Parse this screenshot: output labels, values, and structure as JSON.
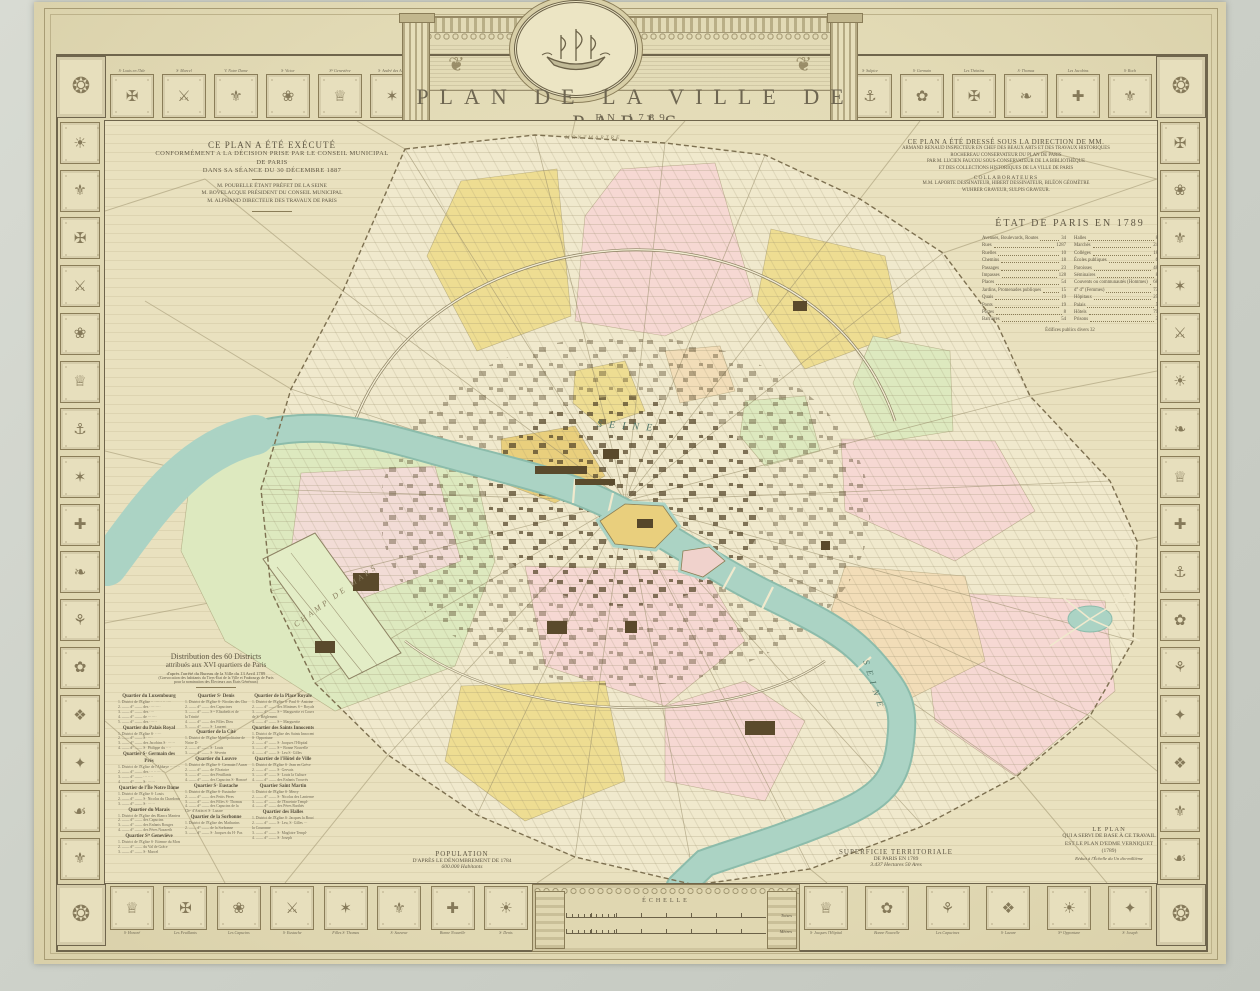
{
  "colors": {
    "paper": "#e3dbb6",
    "map_paper": "#f0e9cd",
    "river": "#abd3c4",
    "yellow": "#eedd92",
    "pink": "#f6d8d3",
    "green": "#dde9bf",
    "peach": "#f2ddb8",
    "gold": "#e9cf7d",
    "ink": "#5f5744",
    "sepia": "#8a7d58"
  },
  "title": {
    "line1": "PLAN DE LA VILLE DE PARIS",
    "line2": "EN 1789"
  },
  "left_note": {
    "l1": "CE PLAN A ÉTÉ EXÉCUTÉ",
    "l2": "CONFORMÉMENT A LA DÉCISION PRISE PAR LE CONSEIL MUNICIPAL",
    "l3": "DE PARIS",
    "l4": "DANS SA SÉANCE DU 30 DÉCEMBRE 1887",
    "l5": "M. POUBELLE ÉTANT PRÉFET DE LA SEINE",
    "l6": "M. BOVELACQUE PRÉSIDENT DU CONSEIL MUNICIPAL",
    "l7": "M. ALPHAND DIRECTEUR DES TRAVAUX DE PARIS"
  },
  "right_note": {
    "l1": "CE PLAN A ÉTÉ DRESSÉ SOUS LA DIRECTION DE MM.",
    "l2": "ARMAND RENAUD INSPECTEUR EN CHEF DES BEAUX ARTS ET DES TRAVAUX HISTORIQUES",
    "l3": "ROCHEREAU CONSERVATEUR DU PLAN DE PARIS",
    "l4": "PAR M. LUCIEN FAUCOU SOUS-CONSERVATEUR DE LA BIBLIOTHÈQUE",
    "l5": "ET DES COLLECTIONS HISTORIQUES DE LA VILLE DE PARIS",
    "collab_title": "COLLABORATEURS",
    "c1": "M.M. LAPORTE DESSINATEUR, HIBERT DESSINATEUR, BILÉON GÉOMÈTRE",
    "c2": "WUHRER GRAVEUR, SULPIS GRAVEUR."
  },
  "etat": {
    "title": "ÉTAT DE PARIS EN 1789",
    "left": [
      {
        "label": "Avenues, Boulevards, Routes",
        "value": "34"
      },
      {
        "label": "Rues",
        "value": "1287"
      },
      {
        "label": "Ruelles",
        "value": "10"
      },
      {
        "label": "Chemins",
        "value": "18"
      },
      {
        "label": "Passages",
        "value": "23"
      },
      {
        "label": "Impasses",
        "value": "128"
      },
      {
        "label": "Places",
        "value": "54"
      },
      {
        "label": "Jardins, Promenades publiques",
        "value": "15"
      },
      {
        "label": "Quais",
        "value": "19"
      },
      {
        "label": "Ponts",
        "value": "19"
      },
      {
        "label": "Portes",
        "value": "8"
      },
      {
        "label": "Barrières",
        "value": "54"
      }
    ],
    "right": [
      {
        "label": "Halles",
        "value": "8"
      },
      {
        "label": "Marchés",
        "value": "24"
      },
      {
        "label": "Collèges",
        "value": "18"
      },
      {
        "label": "Écoles publiques",
        "value": "6"
      },
      {
        "label": "Paroisses",
        "value": "48"
      },
      {
        "label": "Séminaires",
        "value": "8"
      },
      {
        "label": "Couvents ou communautés (Hommes)",
        "value": "68"
      },
      {
        "label": "d°          d°          (Femmes)",
        "value": "73"
      },
      {
        "label": "Hôpitaux",
        "value": "25"
      },
      {
        "label": "Palais",
        "value": "5"
      },
      {
        "label": "Hôtels",
        "value": "79"
      },
      {
        "label": "Prisons",
        "value": "3"
      }
    ],
    "footer": "Édifices publics divers    32"
  },
  "distribution": {
    "t1": "Distribution des 60 Districts",
    "t2": "attribués aux XVI quartiers de Paris",
    "t3": "d'après l'arrêté du Bureau de la Ville du 13 Avril 1789",
    "t4": "(Convocation des habitants du Tiers-État de la Ville et Faubourgs de Paris",
    "t5": "pour la nomination des Électeurs aux États Généraux)",
    "col1": [
      {
        "c": "qh",
        "s": "Quartier du Luxembourg"
      },
      {
        "c": "qe",
        "s": "1. District de l'Église ·· ······ ·· ····"
      },
      {
        "c": "qe",
        "s": "2. ――  d°  ―― des ·········"
      },
      {
        "c": "qe",
        "s": "3. ――  d°  ―― des ····"
      },
      {
        "c": "qe",
        "s": "4. ――  d°  ―― de ·······"
      },
      {
        "c": "qe",
        "s": "5. ――  d°  ―― des ······"
      },
      {
        "c": "qh",
        "s": "Quartier du Palais Royal"
      },
      {
        "c": "qe",
        "s": "1. District de l'Église S· ·····"
      },
      {
        "c": "qe",
        "s": "2. ――  d°  ―― S· ····"
      },
      {
        "c": "qe",
        "s": "3. ――  d°  ―― des Jacobins S· ······"
      },
      {
        "c": "qe",
        "s": "4. ――  d°  ―― S· Philippe du ····"
      },
      {
        "c": "qh",
        "s": "Quartier S· Germain des Prés"
      },
      {
        "c": "qe",
        "s": "1. District de l'Église de l'Abbaye ········"
      },
      {
        "c": "qe",
        "s": "2. ――  d°  ―― des ··· ·········"
      },
      {
        "c": "qe",
        "s": "3. ――  d°  ―― ··· ····"
      },
      {
        "c": "qe",
        "s": "4. ――  d°  ―― S· ······"
      },
      {
        "c": "qh",
        "s": "Quartier de l'Île Notre Dame"
      },
      {
        "c": "qe",
        "s": "1. District de l'Église S· Louis"
      },
      {
        "c": "qe",
        "s": "2. ――  d°  ―― S· Nicolas du Chardonnet"
      },
      {
        "c": "qe",
        "s": "3. ――  d°  ―― S· ······"
      },
      {
        "c": "qh",
        "s": "Quartier du Marais"
      },
      {
        "c": "qe",
        "s": "1. District de l'Église des Blancs Manteaux"
      },
      {
        "c": "qe",
        "s": "2. ――  d°  ―― des Capucins"
      },
      {
        "c": "qe",
        "s": "3. ――  d°  ―― des Enfants Rouges"
      },
      {
        "c": "qe",
        "s": "4. ――  d°  ―― des Pères Nazareth"
      },
      {
        "c": "qh",
        "s": "Quartier Sᵗᵉ Geneviève"
      },
      {
        "c": "qe",
        "s": "1. District de l'Église S· Étienne du Mont"
      },
      {
        "c": "qe",
        "s": "2. ――  d°  ―― du Val de Grâce"
      },
      {
        "c": "qe",
        "s": "3. ――  d°  ―― S· Marcel"
      }
    ],
    "col2": [
      {
        "c": "qh",
        "s": "Quartier S· Denis"
      },
      {
        "c": "qe",
        "s": "1. District de l'Église S· Nicolas des Champs"
      },
      {
        "c": "qe",
        "s": "2. ――  d°  ―― des Capucines"
      },
      {
        "c": "qe",
        "s": "3. ――  d°  ―― S·ᵗᵉ Élisabeth et de"
      },
      {
        "c": "qe",
        "s": "      la Trinité"
      },
      {
        "c": "qe",
        "s": "4. ――  d°  ―― des Filles Dieu"
      },
      {
        "c": "qe",
        "s": "5. ――  d°  ―― S· Laurent"
      },
      {
        "c": "qh",
        "s": "Quartier de la Cité"
      },
      {
        "c": "qe",
        "s": "1. District de l'Église Métropolitaine de"
      },
      {
        "c": "qe",
        "s": "      Notre D·"
      },
      {
        "c": "qe",
        "s": "2. ――  d°  ―― S· Louis"
      },
      {
        "c": "qe",
        "s": "3. ――  d°  ―― S· Séverin"
      },
      {
        "c": "qh",
        "s": "Quartier du Louvre"
      },
      {
        "c": "qe",
        "s": "1. District de l'Église S· Germain l'Auxerrois"
      },
      {
        "c": "qe",
        "s": "2. ――  d°  ―― de l'Oratoire"
      },
      {
        "c": "qe",
        "s": "3. ――  d°  ―― des Feuillants"
      },
      {
        "c": "qe",
        "s": "4. ――  d°  ―― des Capucins S· Honoré"
      },
      {
        "c": "qh",
        "s": "Quartier S· Eustache"
      },
      {
        "c": "qe",
        "s": "1. District de l'Église S· Eustache"
      },
      {
        "c": "qe",
        "s": "2. ――  d°  ―― des Petits Pères"
      },
      {
        "c": "qe",
        "s": "3. ――  d°  ―― des Filles S· Thomas"
      },
      {
        "c": "qe",
        "s": "4. ――  d°  ―― des Capucins de la"
      },
      {
        "c": "qe",
        "s": "      Chᵉᵉ d'Antin et S· Lazare"
      },
      {
        "c": "qh",
        "s": "Quartier de la Sorbonne"
      },
      {
        "c": "qe",
        "s": "1. District de l'Église des Mathurins"
      },
      {
        "c": "qe",
        "s": "2. ――  d°  ―― de la Sorbonne"
      },
      {
        "c": "qe",
        "s": "3. ――  d°  ―― S· Jacques du H· Pas"
      }
    ],
    "col3": [
      {
        "c": "qh",
        "s": "Quartier de la Place Royale"
      },
      {
        "c": "qe",
        "s": "1. District de l'Église S· Paul S· Antoine"
      },
      {
        "c": "qe",
        "s": "2. ――  d°  ―― des Minimes S·ᵗᵉ Royale"
      },
      {
        "c": "qe",
        "s": "3. ――  d°  ―― S·ᵗᵉ Marguerite et Couvent"
      },
      {
        "c": "qe",
        "s": "      de S· Règlement"
      },
      {
        "c": "qe",
        "s": "4. ――  d°  ―― S·ᵗᵉ Marguerite"
      },
      {
        "c": "qh",
        "s": "Quartier des Saints Innocents"
      },
      {
        "c": "qe",
        "s": "1. District de l'Église des Saints Innocents et"
      },
      {
        "c": "qe",
        "s": "      S· Opportune"
      },
      {
        "c": "qe",
        "s": "2. ――  d°  ―― S· Jacques l'Hôpital"
      },
      {
        "c": "qe",
        "s": "3. ――  d°  ―― S·ᵗᵉ Bonne Nouvelle"
      },
      {
        "c": "qe",
        "s": "4. ――  d°  ―― S· Leu S· Gilles"
      },
      {
        "c": "qh",
        "s": "Quartier de l'Hôtel de Ville"
      },
      {
        "c": "qe",
        "s": "1. District de l'Église S· Jean en Grève"
      },
      {
        "c": "qe",
        "s": "2. ――  d°  ―― S· Gervais"
      },
      {
        "c": "qe",
        "s": "3. ――  d°  ―― S· Louis la Culture"
      },
      {
        "c": "qe",
        "s": "4. ――  d°  ―― des Enfants Trouvés"
      },
      {
        "c": "qh",
        "s": "Quartier Saint Martin"
      },
      {
        "c": "qe",
        "s": "1. District de l'Église S· Merry"
      },
      {
        "c": "qe",
        "s": "2. ――  d°  ―― S· Nicolas des Lanternes"
      },
      {
        "c": "qe",
        "s": "3. ――  d°  ―― de l'Enceinte Templᵉ"
      },
      {
        "c": "qe",
        "s": "4. ――  d°  ―― des Pères Barthés"
      },
      {
        "c": "qh",
        "s": "Quartier des Halles"
      },
      {
        "c": "qe",
        "s": "1. District de l'Église S· Jacques la Boucherie"
      },
      {
        "c": "qe",
        "s": "2. ――  d°  ―― S· Leu, S· Gilles ···"
      },
      {
        "c": "qe",
        "s": "      la Couronne"
      },
      {
        "c": "qe",
        "s": "3. ――  d°  ―― S· Magloire Templᵉ"
      },
      {
        "c": "qe",
        "s": "4. ――  d°  ―― S· Joseph"
      }
    ]
  },
  "population": {
    "l1": "POPULATION",
    "l2": "D'APRÈS LE DÉNOMBREMENT DE 1784",
    "l3": "600.000 Habitants"
  },
  "superficie": {
    "l1": "SUPERFICIE TERRITORIALE",
    "l2": "DE PARIS EN 1789",
    "l3": "3.437 Hectares 50 Ares"
  },
  "base_plan": {
    "l1": "LE PLAN",
    "l2": "QUI A SERVI DE BASE À CE TRAVAIL",
    "l3": "EST LE PLAN D'EDME VERNIQUET",
    "l4": "(1789)",
    "l5": "Réduit à l'Échelle du Un dix-millième"
  },
  "scale": {
    "title": "ÉCHELLE",
    "unit1": "Toises",
    "unit2": "Mètres"
  },
  "map": {
    "labels": [
      {
        "text": "SEINE"
      },
      {
        "text": "SEINE"
      },
      {
        "text": "CHAMP DE MARS"
      },
      {
        "text": "MONTMARTRE"
      }
    ]
  },
  "border": {
    "corner_glyph": "❂",
    "left": [
      "☀",
      "⚜",
      "✠",
      "⚔",
      "❀",
      "♕",
      "⚓",
      "✶",
      "✚",
      "❧",
      "⚘",
      "✿",
      "❖",
      "✦",
      "☙",
      "⚜"
    ],
    "right": [
      "✠",
      "❀",
      "⚜",
      "✶",
      "⚔",
      "☀",
      "❧",
      "♕",
      "✚",
      "⚓",
      "✿",
      "⚘",
      "✦",
      "❖",
      "⚜",
      "☙"
    ],
    "top_left": [
      {
        "g": "✠",
        "l": "S· Louis en l'Isle"
      },
      {
        "g": "⚔",
        "l": "S· Marcel"
      },
      {
        "g": "⚜",
        "l": "V. Notre Dame"
      },
      {
        "g": "❀",
        "l": "S· Victor"
      },
      {
        "g": "♕",
        "l": "Sᵗᵉ Geneviève"
      },
      {
        "g": "✶",
        "l": "S· André des Arts"
      }
    ],
    "top_right": [
      {
        "g": "⚓",
        "l": "S· Sulpice"
      },
      {
        "g": "✿",
        "l": "S· Germain"
      },
      {
        "g": "✠",
        "l": "Les Théatins"
      },
      {
        "g": "❧",
        "l": "S· Thomas"
      },
      {
        "g": "✚",
        "l": "Les Jacobins"
      },
      {
        "g": "⚜",
        "l": "S· Roch"
      }
    ],
    "bottom_left": [
      {
        "g": "♕",
        "l": "S· Honoré"
      },
      {
        "g": "✠",
        "l": "Les Feuillants"
      },
      {
        "g": "❀",
        "l": "Les Capucins"
      },
      {
        "g": "⚔",
        "l": "S· Eustache"
      },
      {
        "g": "✶",
        "l": "Filles S· Thomas"
      },
      {
        "g": "⚜",
        "l": "S· Sauveur"
      },
      {
        "g": "✚",
        "l": "Bonne Nouvelle"
      },
      {
        "g": "☀",
        "l": "S· Denis"
      }
    ],
    "bottom_right": [
      {
        "g": "♕",
        "l": "S· Jacques l'Hôpital"
      },
      {
        "g": "✿",
        "l": "Bonne Nouvelle"
      },
      {
        "g": "⚘",
        "l": "Les Capucines"
      },
      {
        "g": "❖",
        "l": "S· Lazare"
      },
      {
        "g": "☀",
        "l": "Sᵗᵉ Opportune"
      },
      {
        "g": "✦",
        "l": "S· Joseph"
      }
    ]
  }
}
